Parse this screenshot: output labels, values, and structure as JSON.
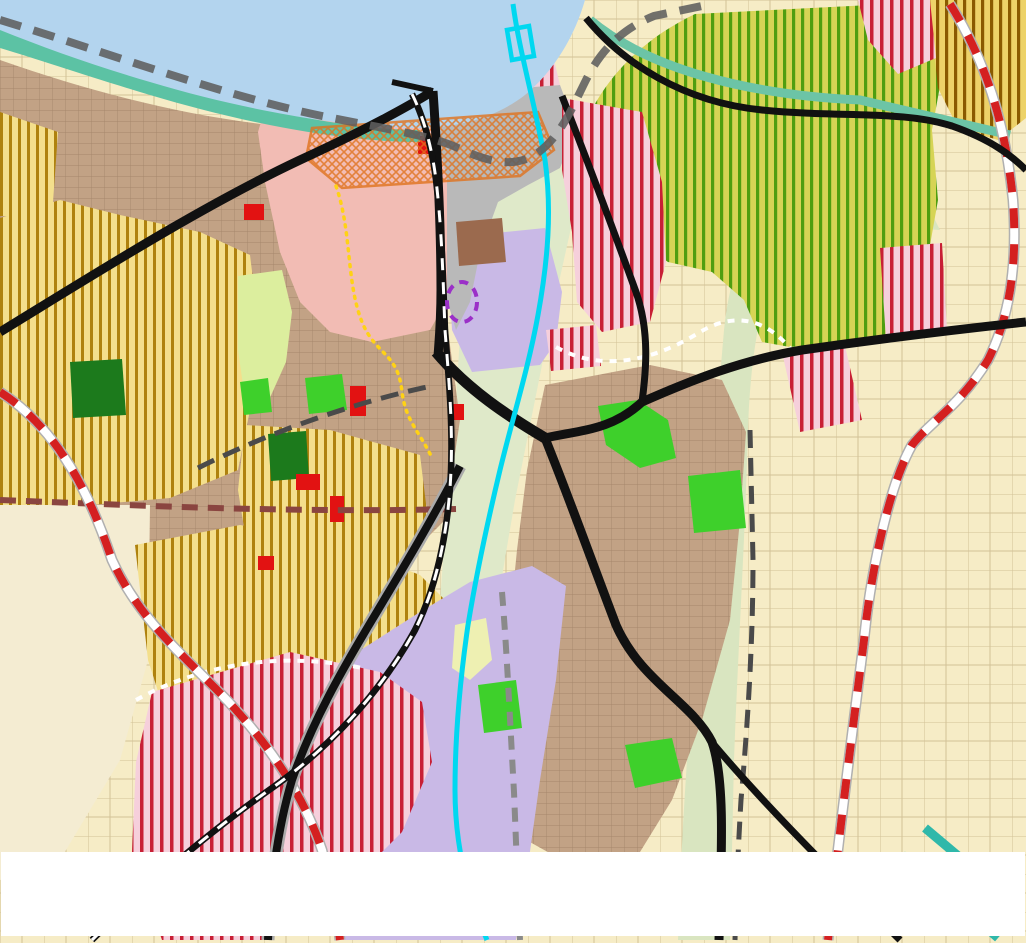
{
  "map": {
    "street_labels": [
      {
        "text": "ул. \"А. СТАМБОЛИЙСКИ\"",
        "x": 200,
        "y": 167
      },
      {
        "text": "ул. \"ПРИСТАНИЩНА\"",
        "x": 516,
        "y": 268
      },
      {
        "text": "НАДЛЕЗ И МОСТ",
        "x": 515,
        "y": 383
      },
      {
        "text": "ул. \"КОВАЧИШКА\"",
        "x": 701,
        "y": 425
      },
      {
        "text": "ул. \"СОФИЙСКА\"",
        "x": 603,
        "y": 588
      },
      {
        "text": "ул. \"БЕЛОГРАДЧИШКО ШОСЕ\"",
        "x": 297,
        "y": 659
      }
    ],
    "road_labels": [
      {
        "text": "МОН3139",
        "x": 147,
        "y": 493,
        "rot": -7,
        "fs": 17
      },
      {
        "text": "МОН3138",
        "x": 633,
        "y": 30,
        "rot": -25,
        "fs": 17
      },
      {
        "text": "МОН2135",
        "x": 637,
        "y": 234,
        "rot": -49,
        "fs": 17
      },
      {
        "text": "2136",
        "x": 519,
        "y": 815,
        "rot": -74,
        "fs": 17
      },
      {
        "text": "II-11",
        "x": 927,
        "y": 318,
        "rot": -6,
        "fs": 26
      }
    ],
    "place_labels": [
      {
        "text": "р. Дунав",
        "x": 420,
        "y": 19,
        "rot": -8,
        "kind": "river"
      },
      {
        "text": "Пристанищен\nтерминал Лом",
        "x": 341,
        "y": 52,
        "rot": 0,
        "kind": "port2"
      },
      {
        "text": "ЛОМ",
        "x": 290,
        "y": 414,
        "rot": 0,
        "kind": "lom-big"
      },
      {
        "text": "ЛОМ",
        "x": 795,
        "y": 507,
        "rot": 0,
        "kind": "lom-small"
      },
      {
        "text": "кв. Младеново",
        "x": 793,
        "y": 529,
        "rot": -3,
        "kind": "kvartal"
      }
    ],
    "cadastre_boxes": [
      {
        "line1": "Землище",
        "line2": "44238",
        "x": 174,
        "y": 473
      },
      {
        "line1": "Землище",
        "line2": "44238",
        "x": 794,
        "y": 552
      }
    ],
    "zone_markers": [
      [
        257,
        84,
        "2",
        "Ози"
      ],
      [
        313,
        80,
        "1",
        "Ц"
      ],
      [
        297,
        110,
        "3",
        "Оо"
      ],
      [
        363,
        90,
        "1",
        "Жк"
      ],
      [
        565,
        88,
        "1",
        "Ок1"
      ],
      [
        741,
        66,
        "1",
        "Ов"
      ],
      [
        907,
        14,
        "1",
        "дОв"
      ],
      [
        905,
        133,
        "5",
        "Ов"
      ],
      [
        184,
        115,
        "3",
        "Жм"
      ],
      [
        13,
        190,
        "2",
        "Жм"
      ],
      [
        33,
        253,
        "1",
        "дЖм"
      ],
      [
        399,
        183,
        "4",
        "Оо"
      ],
      [
        353,
        204,
        "2",
        "Ц"
      ],
      [
        410,
        210,
        "1",
        "Оз"
      ],
      [
        583,
        177,
        "3",
        "Смф1"
      ],
      [
        615,
        224,
        "4",
        "Смф1"
      ],
      [
        525,
        240,
        "5",
        "Смф"
      ],
      [
        581,
        292,
        "6",
        "Смф1"
      ],
      [
        583,
        334,
        "7",
        "Смф1"
      ],
      [
        697,
        290,
        "6",
        "Ов"
      ],
      [
        783,
        345,
        "5",
        "Смф1"
      ],
      [
        720,
        365,
        "1",
        "дОв"
      ],
      [
        156,
        349,
        "4",
        "Смф"
      ],
      [
        312,
        282,
        "3",
        "Жм"
      ],
      [
        382,
        338,
        "2",
        "Жк"
      ],
      [
        361,
        377,
        "6",
        "Оо"
      ],
      [
        379,
        412,
        "7",
        "Оо"
      ],
      [
        318,
        390,
        "2",
        "Оз"
      ],
      [
        331,
        443,
        "11",
        "Оо"
      ],
      [
        366,
        443,
        "1",
        "Жс"
      ],
      [
        415,
        444,
        "6",
        "Смф"
      ],
      [
        399,
        492,
        "8",
        "Оо"
      ],
      [
        293,
        528,
        "10",
        "Оо"
      ],
      [
        326,
        543,
        "9",
        "Оо"
      ],
      [
        292,
        567,
        "4",
        "Жк"
      ],
      [
        261,
        490,
        "3",
        "Жк"
      ],
      [
        237,
        547,
        "7",
        "Смф"
      ],
      [
        323,
        605,
        "4",
        "Жм"
      ],
      [
        209,
        632,
        "2",
        "дСмф"
      ],
      [
        256,
        752,
        "8",
        "Смф"
      ],
      [
        413,
        629,
        "3",
        "Пп"
      ],
      [
        498,
        345,
        "2",
        "Пп"
      ],
      [
        566,
        362,
        "8",
        ""
      ],
      [
        640,
        373,
        "6",
        "Жм"
      ],
      [
        533,
        407,
        "5",
        "Жм"
      ],
      [
        546,
        485,
        "12",
        "Жм"
      ],
      [
        656,
        516,
        "8",
        "Жм"
      ],
      [
        722,
        497,
        "3",
        "Оз"
      ],
      [
        618,
        665,
        "9",
        "Жм"
      ],
      [
        723,
        665,
        "4",
        "Оз"
      ],
      [
        496,
        704,
        "6",
        "Оз"
      ],
      [
        547,
        716,
        "7",
        "Оз"
      ],
      [
        651,
        770,
        "5",
        "Оз"
      ],
      [
        520,
        780,
        "10",
        "Жм"
      ],
      [
        476,
        800,
        "11",
        "Жм"
      ],
      [
        568,
        600,
        "",
        "Оз"
      ],
      [
        607,
        597,
        "",
        "Оз"
      ]
    ],
    "t_markers": [
      [
        160,
        205
      ],
      [
        257,
        218
      ],
      [
        462,
        185
      ],
      [
        405,
        243
      ],
      [
        441,
        304
      ],
      [
        266,
        337
      ],
      [
        93,
        390
      ],
      [
        287,
        457
      ],
      [
        622,
        335
      ],
      [
        617,
        466
      ],
      [
        529,
        633
      ],
      [
        546,
        685
      ],
      [
        497,
        753
      ],
      [
        996,
        318
      ]
    ],
    "poi_icons": [
      {
        "x": 238,
        "y": 137,
        "type": "monument",
        "variant": "orange"
      },
      {
        "x": 350,
        "y": 138,
        "type": "monument",
        "variant": "orange"
      },
      {
        "x": 380,
        "y": 225,
        "type": "monument",
        "variant": "orange"
      },
      {
        "x": 372,
        "y": 276,
        "type": "monument",
        "variant": "orange"
      },
      {
        "x": 345,
        "y": 320,
        "type": "monument",
        "variant": "orange"
      },
      {
        "x": 367,
        "y": 487,
        "type": "monument",
        "variant": "orange"
      },
      {
        "x": 628,
        "y": 633,
        "type": "monument",
        "variant": "orange"
      },
      {
        "x": 397,
        "y": 79,
        "type": "monument",
        "variant": "green"
      },
      {
        "x": 322,
        "y": 150,
        "type": "monument",
        "variant": "green"
      },
      {
        "x": 308,
        "y": 188,
        "type": "monument",
        "variant": "green"
      },
      {
        "x": 393,
        "y": 467,
        "type": "monument",
        "variant": "blue"
      },
      {
        "x": 663,
        "y": 627,
        "type": "monument",
        "variant": "blue"
      },
      {
        "x": 265,
        "y": 132,
        "type": "arrow",
        "variant": "black"
      },
      {
        "x": 338,
        "y": 180,
        "type": "club",
        "variant": "black"
      },
      {
        "x": 290,
        "y": 208,
        "type": "mound",
        "variant": "black"
      },
      {
        "x": 482,
        "y": 161,
        "type": "anchor",
        "variant": "black"
      },
      {
        "x": 442,
        "y": 335,
        "type": "truck",
        "variant": "black"
      },
      {
        "x": 283,
        "y": 695,
        "type": "lightning",
        "variant": "black"
      },
      {
        "x": 270,
        "y": 786,
        "type": "railcross",
        "variant": "white"
      },
      {
        "x": 521,
        "y": 80,
        "type": "fan",
        "variant": "white"
      },
      {
        "x": 490,
        "y": 290,
        "type": "warning",
        "variant": "yellow"
      }
    ],
    "dots": [
      [
        120,
        138,
        "red"
      ],
      [
        104,
        195,
        "red"
      ],
      [
        656,
        460,
        "red"
      ],
      [
        478,
        763,
        "red"
      ],
      [
        983,
        203,
        "red"
      ],
      [
        769,
        619,
        "red"
      ],
      [
        285,
        87,
        "blue"
      ]
    ]
  },
  "footer": {
    "lines": [
      [
        {
          "text": "ОБОЗНАЧЕНИТЕ НА КАРТАТА УЛИЦИ: „АЛЕКСАНДЪР СТАМБОЛИЙСКИ“",
          "bold": true
        },
        {
          "text": " - част от Републикански път (РП) II-11, ",
          "bold": false
        },
        {
          "text": "„ПРИСТАНИЩНА“",
          "bold": true
        },
        {
          "text": " – част от РП",
          "bold": false
        }
      ],
      [
        {
          "text": "II-11, ",
          "bold": false
        },
        {
          "text": "НАДЛЕЗ И МОСТ НАД РЕКА ЛОМ",
          "bold": true
        },
        {
          "text": " – част от РП II-11, ",
          "bold": false
        },
        {
          "text": "„СОФИЙСКА“",
          "bold": true
        },
        {
          "text": " – част от РП II-81, ",
          "bold": false
        },
        {
          "text": "„КОВАЧИШКА“",
          "bold": true
        },
        {
          "text": " – част от РП II-11, ",
          "bold": false
        },
        {
          "text": "„БЕЛОГРАДЧИШКО",
          "bold": true
        }
      ],
      [
        {
          "text": "ШОСЕ“",
          "bold": true
        },
        {
          "text": " – част от РП III-114, ",
          "bold": false
        },
        {
          "text": "СА СОБСТВЕНОСТ НА АГЕНЦИЯ „ПЪТНА ИНФРАСТРУКТУРА“ (АПИ), КОЯТО ОТГОВАРЯ ЗА ТЯХНОТО ТЕКУЩО",
          "bold": true
        }
      ],
      [
        {
          "text": "ПОДДЪРЖАНЕ, ОСНОВНИ РЕМОНТИ И РАЗРЕШИТЕЛНИ РЕЖИМИ.",
          "bold": true
        }
      ]
    ]
  },
  "colors": {
    "marker_orange": "#e8811c",
    "marker_green": "#2ecc2e",
    "marker_blue": "#8aa2ee",
    "marker_black": "#111111",
    "marker_white": "#ffffff",
    "marker_yellow": "#ffd400",
    "dot_red": "#e03030",
    "dot_blue": "#2255cc",
    "water": "#b3d4ee",
    "urban": "#c2a285",
    "lavender": "#c9b9e6",
    "salmon": "#f2bcb4",
    "gray_zone": "#b9b9b9",
    "bright_green": "#3ed02b",
    "dark_green": "#1c7a1c",
    "red_stripe": "#c81f35",
    "yellow_stripe": "#a87800",
    "green_stripe": "#4f9e10"
  }
}
